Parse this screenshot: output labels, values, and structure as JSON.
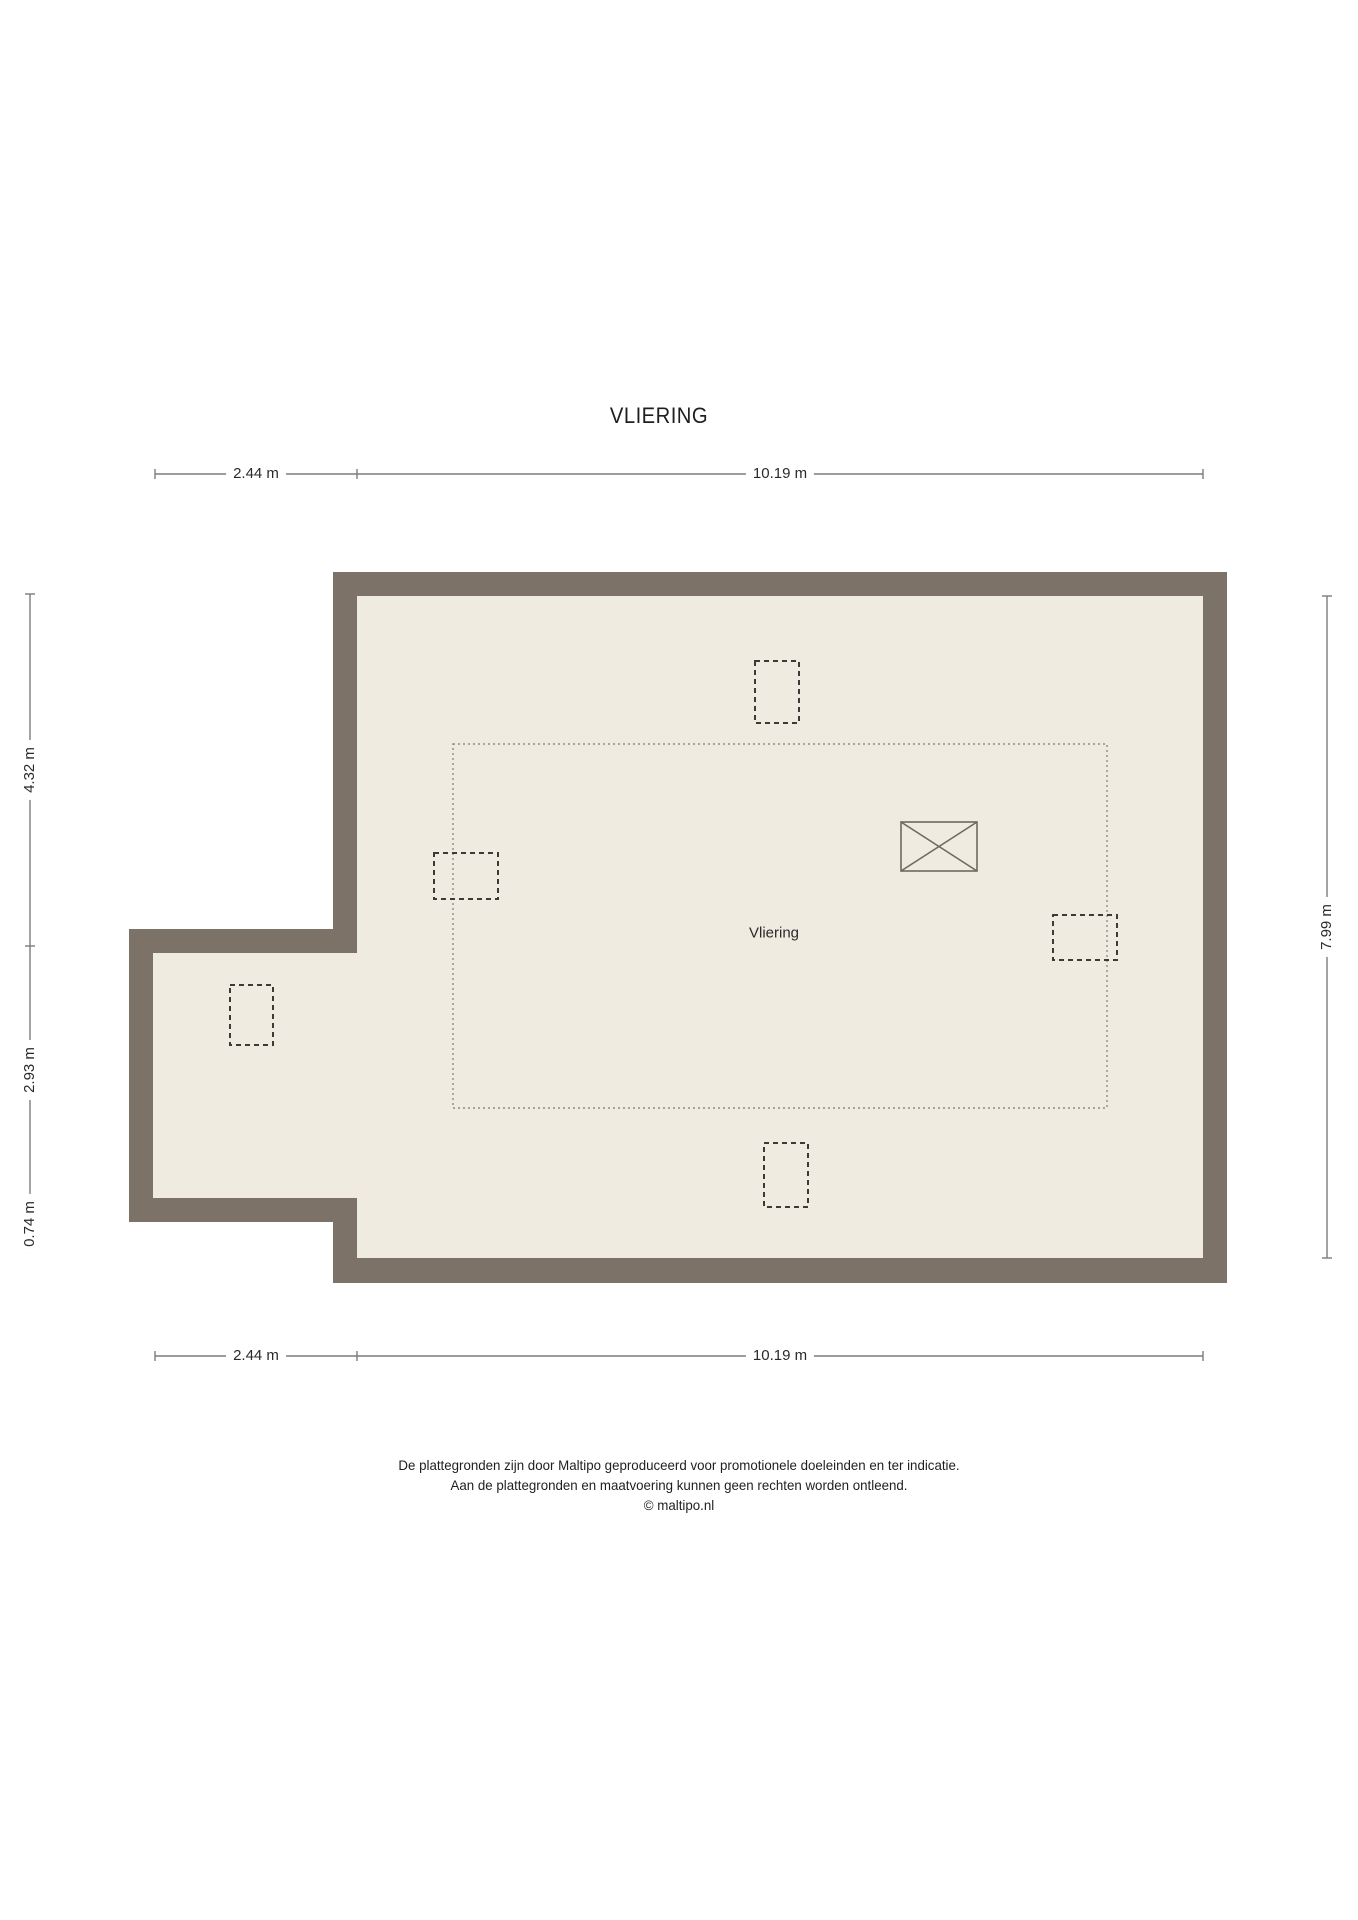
{
  "title": "VLIERING",
  "plan": {
    "room_label": "Vliering"
  },
  "dimensions": {
    "top": {
      "left_label": "2.44 m",
      "right_label": "10.19 m"
    },
    "bottom": {
      "left_label": "2.44 m",
      "right_label": "10.19 m"
    },
    "left": {
      "top_label": "4.32 m",
      "middle_label": "2.93 m",
      "bottom_label": "0.74 m"
    },
    "right": {
      "label": "7.99 m"
    }
  },
  "footer": {
    "line1": "De plattegronden zijn door Maltipo geproduceerd voor promotionele doeleinden en ter indicatie.",
    "line2": "Aan de plattegronden en maatvoering kunnen geen rechten worden ontleend.",
    "line3": "© maltipo.nl"
  },
  "colors": {
    "wall": "#7d7267",
    "floor": "#f0ebe1",
    "dashed_outline": "#3a3a38",
    "dotted_outline": "#8f8b84",
    "shaft_outline": "#6a6a5e",
    "dimension_line": "#7c7c7c",
    "text": "#1f1f1f"
  }
}
